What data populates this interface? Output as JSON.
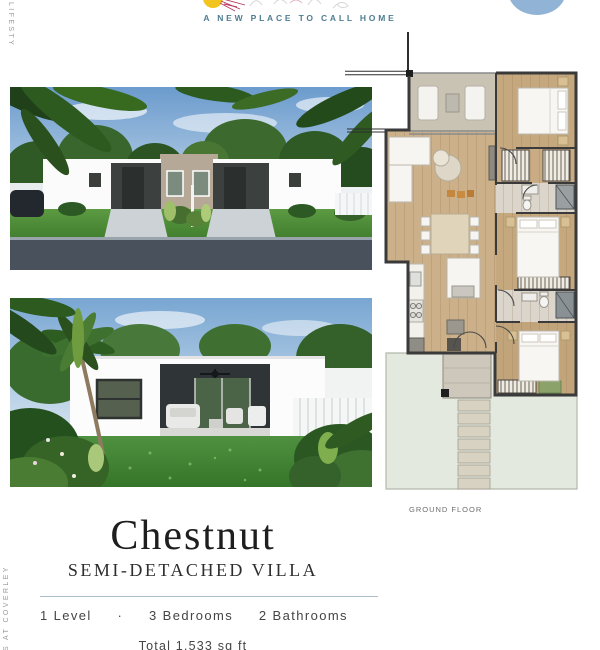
{
  "header": {
    "tagline": "A NEW PLACE TO CALL HOME"
  },
  "side": {
    "top_text": "LIFESTY",
    "bottom_text": "S AT COVERLEY"
  },
  "floor_plan": {
    "label": "GROUND FLOOR"
  },
  "villa": {
    "name": "Chestnut",
    "type": "SEMI-DETACHED VILLA",
    "specs": {
      "levels": "1 Level",
      "separator": "·",
      "bedrooms": "3 Bedrooms",
      "bathrooms": "2 Bathrooms"
    },
    "total_area": "Total 1,533 sq ft"
  },
  "colors": {
    "accent": "#4e7d92",
    "divider": "#a9bdc6",
    "side_text": "#979797",
    "title": "#1e1e1e",
    "text": "#454545",
    "blob": "#91b4d6"
  }
}
